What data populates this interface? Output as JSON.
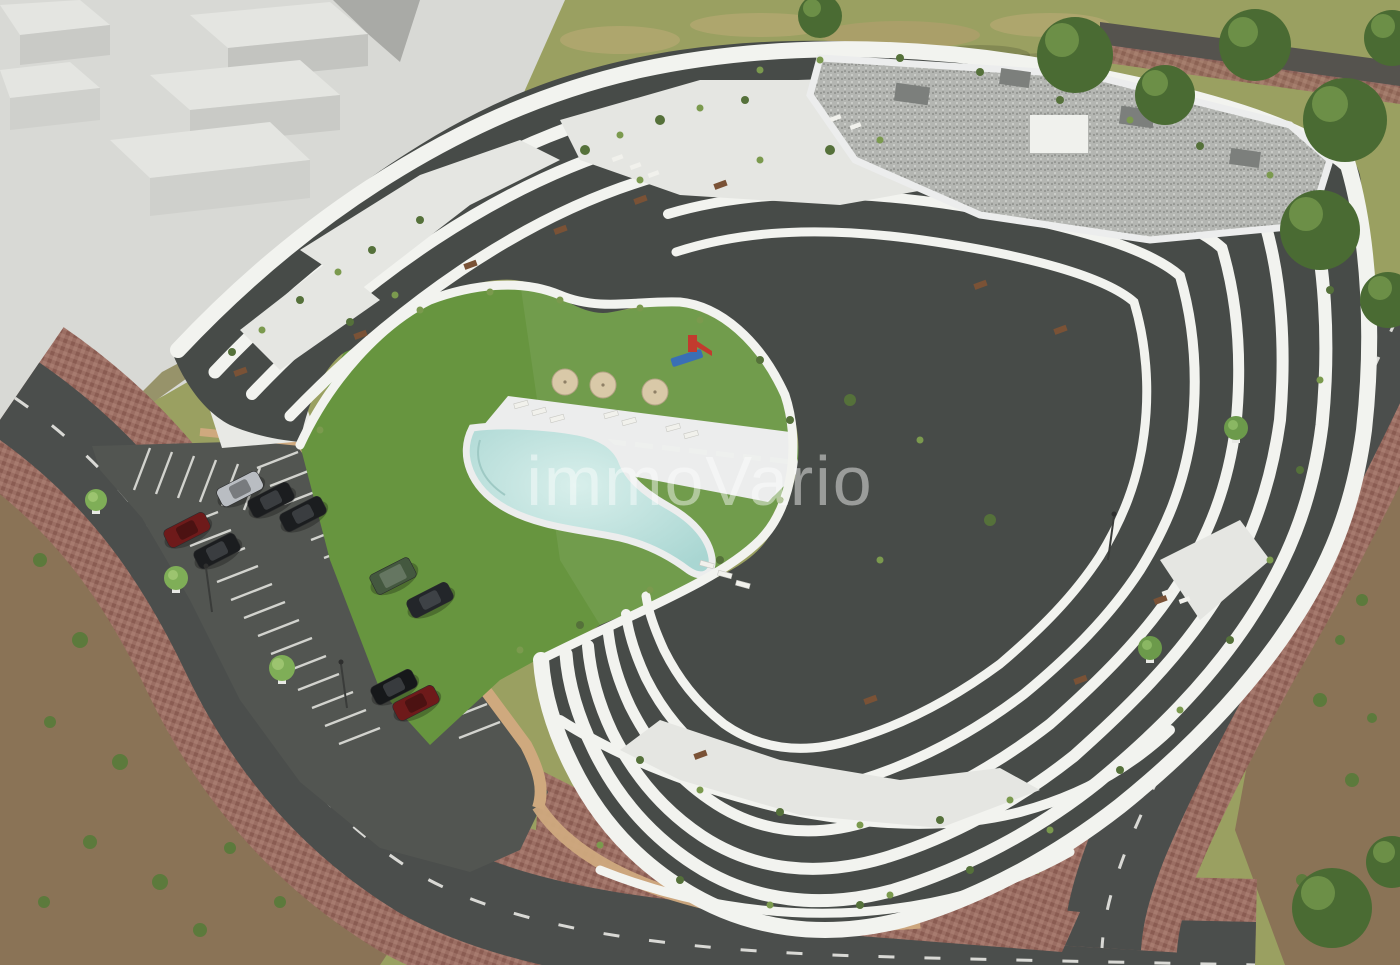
{
  "scene": {
    "type": "architectural-aerial-render",
    "subject": "New-build terraced apartment complex with communal courtyard, pool and parking",
    "watermark": {
      "text": "immoVario",
      "color": "#ffffff",
      "opacity": 0.45
    }
  },
  "palette": {
    "building_white": "#f2f3ef",
    "building_terrace": "#e5e6e2",
    "facade_dark": "#474b48",
    "roof_gravel": "#b4b6b2",
    "roof_rim": "#eceded",
    "massing_gray": "#d8d9d5",
    "massing_top": "#e4e5e1",
    "massing_face": "#c3c4c0",
    "massing_shadow": "#a9aaa6",
    "lawn_green": "#67953f",
    "dry_grass": "#9aa061",
    "dirt_brown": "#8a7356",
    "road_asphalt": "#4b4e4c",
    "parking_asphalt": "#525551",
    "road_marking": "#e9e9e4",
    "sidewalk_paver": "#9b6e63",
    "wall_tan": "#cfa97e",
    "pool_water": "#bfe2de",
    "pool_deck": "#eceded",
    "tree_dark": "#4a6b33",
    "tree_light": "#7fae57",
    "shrub_green": "#55713a",
    "shrub_light": "#7b9a4e",
    "umbrella_beige": "#d9c9a8",
    "playground_red": "#c23b2e",
    "playground_blue": "#3a6fb5",
    "kerb_red": "#7e4a42",
    "furniture_brown": "#7a5236",
    "lounger_white": "#f1f1ec"
  },
  "objects": {
    "neighbor_massing": {
      "label": "Untextured neighboring building massing (white volume study)"
    },
    "building": {
      "label": "Terraced white apartment building",
      "floors_visible": 7,
      "features": [
        "wavy stacked balcony bands",
        "gravel flat roof",
        "planted roof terraces",
        "dark recessed glazed facades"
      ]
    },
    "courtyard": {
      "label": "Communal courtyard",
      "features": [
        "lawn",
        "free-form swimming pool",
        "sun deck with loungers",
        "children playground"
      ]
    },
    "umbrellas": {
      "count": 3
    },
    "playground": {
      "label": "Playground",
      "colors": [
        "#c23b2e",
        "#3a6fb5"
      ]
    },
    "parking": {
      "label": "Surface parking lot with marked stalls",
      "cars": [
        {
          "color": "#b9bdc2",
          "type": "sedan"
        },
        {
          "color": "#1b1d1f",
          "type": "sedan"
        },
        {
          "color": "#1b1d1f",
          "type": "sedan"
        },
        {
          "color": "#6e1a1a",
          "type": "sedan"
        },
        {
          "color": "#1b1d1f",
          "type": "sedan"
        },
        {
          "color": "#44583f",
          "type": "suv"
        },
        {
          "color": "#23262a",
          "type": "sedan"
        },
        {
          "color": "#16181a",
          "type": "sedan"
        },
        {
          "color": "#6e1a1a",
          "type": "sedan"
        }
      ]
    },
    "roads": {
      "label": "Perimeter streets with dashed centre lines and paver sidewalks",
      "count": 2
    },
    "vegetation": {
      "label": "Street trees, perimeter scrubland and terrace planting",
      "street_tree_count": 5
    }
  }
}
